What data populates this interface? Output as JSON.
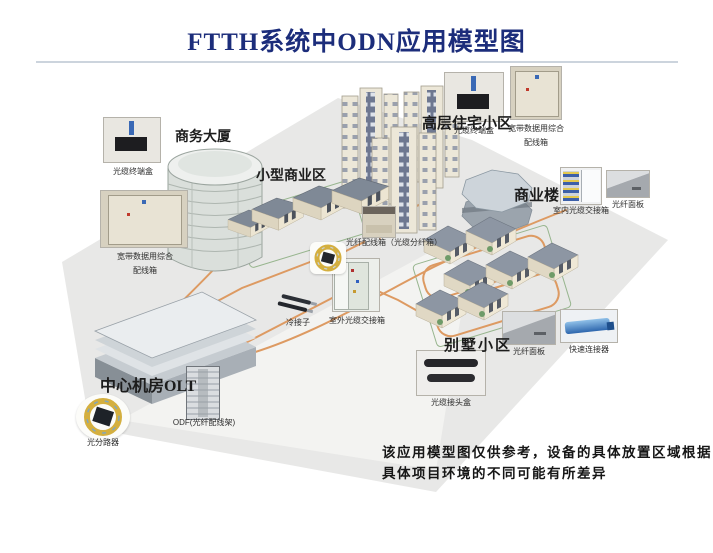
{
  "title": "FTTH系统中ODN应用模型图",
  "areas": {
    "business_tower": "商务大厦",
    "small_commercial": "小型商业区",
    "highrise_residential": "高层住宅小区",
    "commercial_building": "商业楼",
    "villa_district": "别墅小区",
    "central_office": "中心机房OLT"
  },
  "device_labels": {
    "fiber_terminal_box": "光缆终端盒",
    "broadband_box_line1": "宽带数据用综合",
    "broadband_box_line2": "配线箱",
    "fiber_distribution_box": "光纤配线箱（光缆分纤箱）",
    "indoor_cross_connect": "室内光缆交接箱",
    "fiber_panel": "光纤面板",
    "outdoor_cross_connect": "室外光缆交接箱",
    "cold_splice": "冷接子",
    "quick_connector": "快速连接器",
    "splice_closure": "光缆接头盒",
    "optical_splitter": "光分路器",
    "odf": "ODF(光纤配线架)"
  },
  "disclaimer": {
    "line1": "该应用模型图仅供参考，设备的具体放置区域根据",
    "line2": "具体项目环境的不同可能有所差异"
  },
  "colors": {
    "title": "#1c2d7b",
    "cable": "#dd9a62",
    "ground": "#e8e8e7",
    "plot_line": "#97b58e"
  }
}
